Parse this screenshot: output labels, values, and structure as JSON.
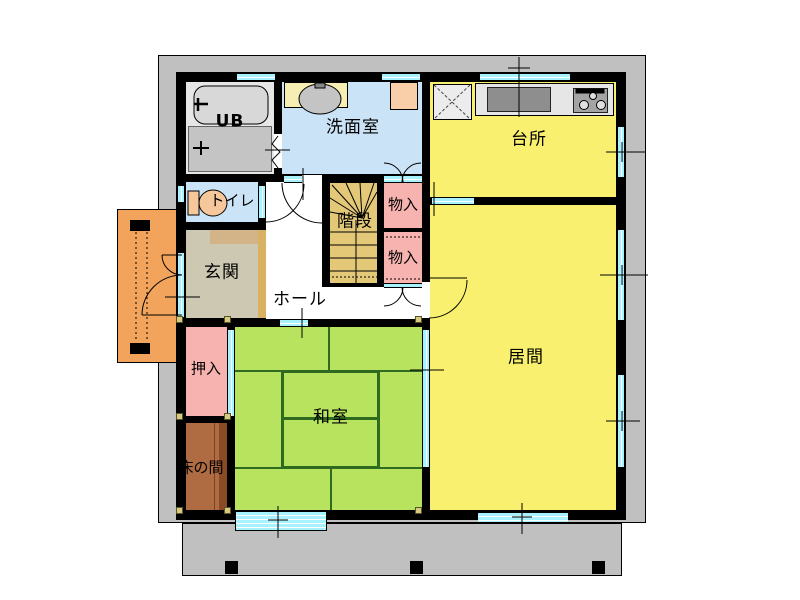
{
  "figure": "japanese-house-first-floor-plan",
  "rooms": {
    "ub": {
      "label": "UB"
    },
    "washroom": {
      "label": "洗面室"
    },
    "kitchen": {
      "label": "台所"
    },
    "toilet": {
      "label": "トイレ"
    },
    "stairs": {
      "label": "階段"
    },
    "closet_upper": {
      "label": "物入"
    },
    "closet_lower": {
      "label": "物入"
    },
    "hall": {
      "label": "ホール"
    },
    "entrance": {
      "label": "玄関"
    },
    "living": {
      "label": "居間"
    },
    "oshiire": {
      "label": "押入"
    },
    "washitsu": {
      "label": "和室"
    },
    "tokonoma": {
      "label": "床の間"
    }
  },
  "icons": {
    "bathtub": "bathtub-plan-symbol",
    "washbasin": "oval-basin-symbol",
    "toilet_bowl": "toilet-plan-symbol",
    "kitchen_sink": "sink-counter-symbol",
    "stove": "three-burner-stove-symbol",
    "refrigerator_space": "x-crossed-square",
    "door_arcs": "swing-door-quarter-arcs",
    "sliding_windows": "cyan-sliding-window-bands"
  },
  "colors": {
    "site_gray": "#C0C0C0",
    "wall_black": "#000000",
    "window_cyan": "#A8F1FF",
    "yellow_floor": "#F8F06E",
    "tatami_green": "#B8E35F",
    "tatami_line": "#2E6B1E",
    "pink_closet": "#F7B3B0",
    "stair_tan": "#E3C878",
    "entrance_beige": "#CDC8B2",
    "entrance_step": "#D2B488",
    "agarikamachi": "#D8B163",
    "tokonoma_brown": "#AF6C43",
    "tokonoma_edge": "#8B4A26",
    "porch_orange": "#F2A45C",
    "bath_gray": "#C4C4C4",
    "washroom_blue": "#CBE3F7",
    "counter_gray": "#E6E6E6",
    "sink_gray": "#8E8E8E",
    "laundry_peach": "#F9CFA9",
    "counter_yellow": "#F7EEB4"
  }
}
